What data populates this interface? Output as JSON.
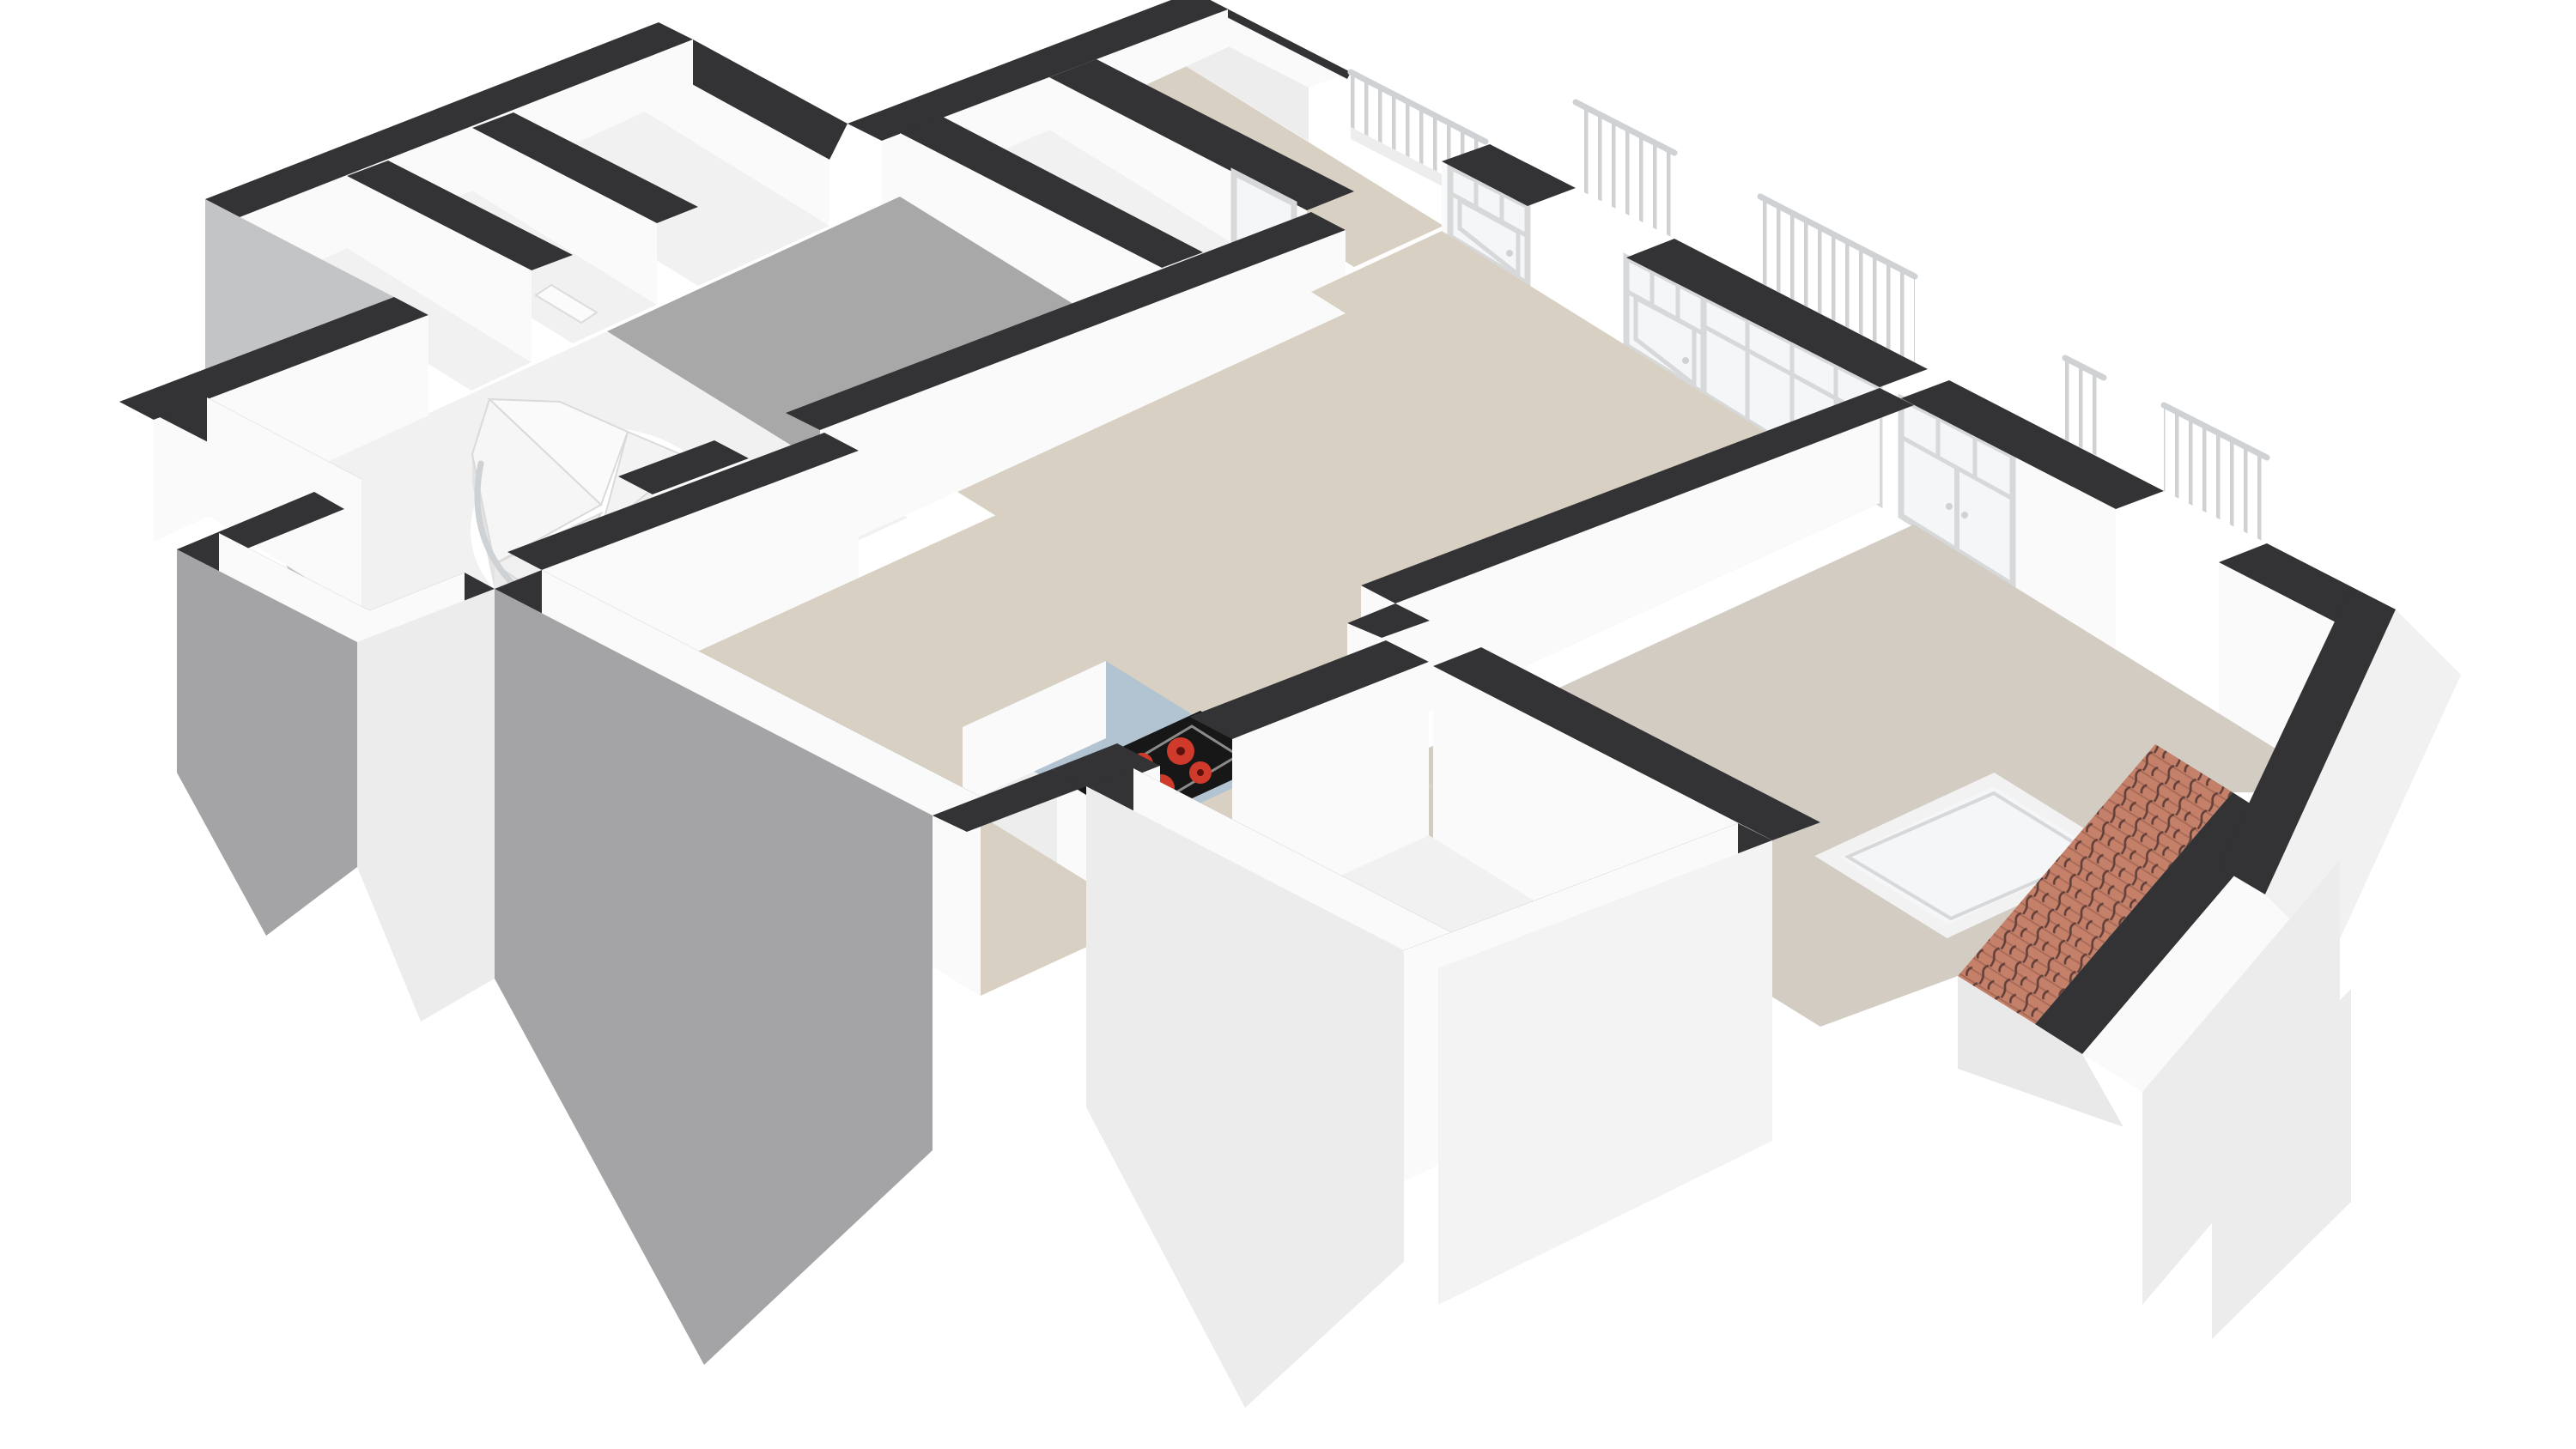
{
  "meta": {
    "kind": "3d-floorplan-render",
    "view": "isometric cutaway of one apartment floor, white background, no text labels"
  },
  "palette": {
    "background": "#ffffff",
    "wallTop": "#333336",
    "whiteFace": "#fafafa",
    "whiteFaceShade": "#ededee",
    "whiteFaceDim": "#e1e2e3",
    "graySkirt": "#a4a4a6",
    "graySkirtLight": "#c3c4c6",
    "whiteSkirt": "#ececec",
    "floorBeige": "#d8d1c3",
    "floorGreige": "#d2ccc3",
    "floorGray": "#a8a8a9",
    "floorWhite": "#f1f1f1",
    "glass": "#f5f6f7",
    "frame": "#d7d8d9",
    "railing": "#cfd2d4",
    "counterBlue": "#b2c4d1",
    "stoveBlack": "#171717",
    "cooktopEdge": "#8a8a8a",
    "burnerRed": "#d03a2b",
    "burnerCore": "#5e100c",
    "tileRed": "#c5806a",
    "tileLine": "#63413a",
    "tileRow": "#a96b57",
    "slopeGray": "#e9e9e9",
    "fixtureWhite": "#fbfbfb",
    "fixtureEdge": "#dcdcdc",
    "stepWhite": "#f4f4f4",
    "stepEdge": "#dadada"
  },
  "scene": {
    "rooms": [
      {
        "name": "terrace-strip",
        "floor": "beige",
        "position": "top, behind parapet"
      },
      {
        "name": "entry-vestibule",
        "floor": "white",
        "position": "upper left of living room"
      },
      {
        "name": "hallway",
        "floor": "gray",
        "position": "left-center"
      },
      {
        "name": "stair-hall",
        "floor": "white",
        "position": "left, contains spiral staircase"
      },
      {
        "name": "storage-room-1",
        "floor": "white",
        "position": "top-left annex"
      },
      {
        "name": "storage-room-2",
        "floor": "white",
        "position": "top-left annex, with washbasin"
      },
      {
        "name": "storage-room-3",
        "floor": "white",
        "position": "top-left annex"
      },
      {
        "name": "balcony-room",
        "floor": "white",
        "position": "bottom-left bump-out"
      },
      {
        "name": "living-room",
        "floor": "beige",
        "position": "center"
      },
      {
        "name": "kitchen",
        "floor": "beige",
        "position": "center-bottom, open plan"
      },
      {
        "name": "bathroom",
        "floor": "white",
        "position": "bottom-center, with bathtub"
      },
      {
        "name": "bedroom",
        "floor": "greige",
        "position": "right, with skylight and tiled roof edge"
      }
    ],
    "fixtures": [
      {
        "name": "spiral-staircase",
        "steps_visible": 9
      },
      {
        "name": "kitchen-counter",
        "top_color": "counterBlue"
      },
      {
        "name": "cooktop",
        "burners": 4,
        "burner_color": "burnerRed"
      },
      {
        "name": "bathtub",
        "faucet": true
      },
      {
        "name": "washbasin",
        "location": "annex storage-room-2"
      },
      {
        "name": "skylight-window",
        "location": "bedroom floor near roof"
      },
      {
        "name": "roof-tile-band",
        "material": "terracotta tiles"
      },
      {
        "name": "balustrade-terrace"
      },
      {
        "name": "balustrade-left"
      },
      {
        "name": "balustrade-center"
      },
      {
        "name": "balustrade-right"
      },
      {
        "name": "balustrade-bedroom"
      }
    ],
    "openings": [
      {
        "name": "terrace-glass-door"
      },
      {
        "name": "facade-door-1",
        "transom": true
      },
      {
        "name": "facade-door-2",
        "transom": true
      },
      {
        "name": "sliding-glass-wall",
        "panels": 4,
        "transom": true
      },
      {
        "name": "bedroom-french-door",
        "leaves": 2,
        "transom": true
      },
      {
        "name": "bathroom-door-gap"
      }
    ],
    "wall_style": {
      "cut_tops": "dark charcoal",
      "interior_faces": "white",
      "exterior_faces": "gray / white with V-shaped hanging skirts"
    }
  }
}
